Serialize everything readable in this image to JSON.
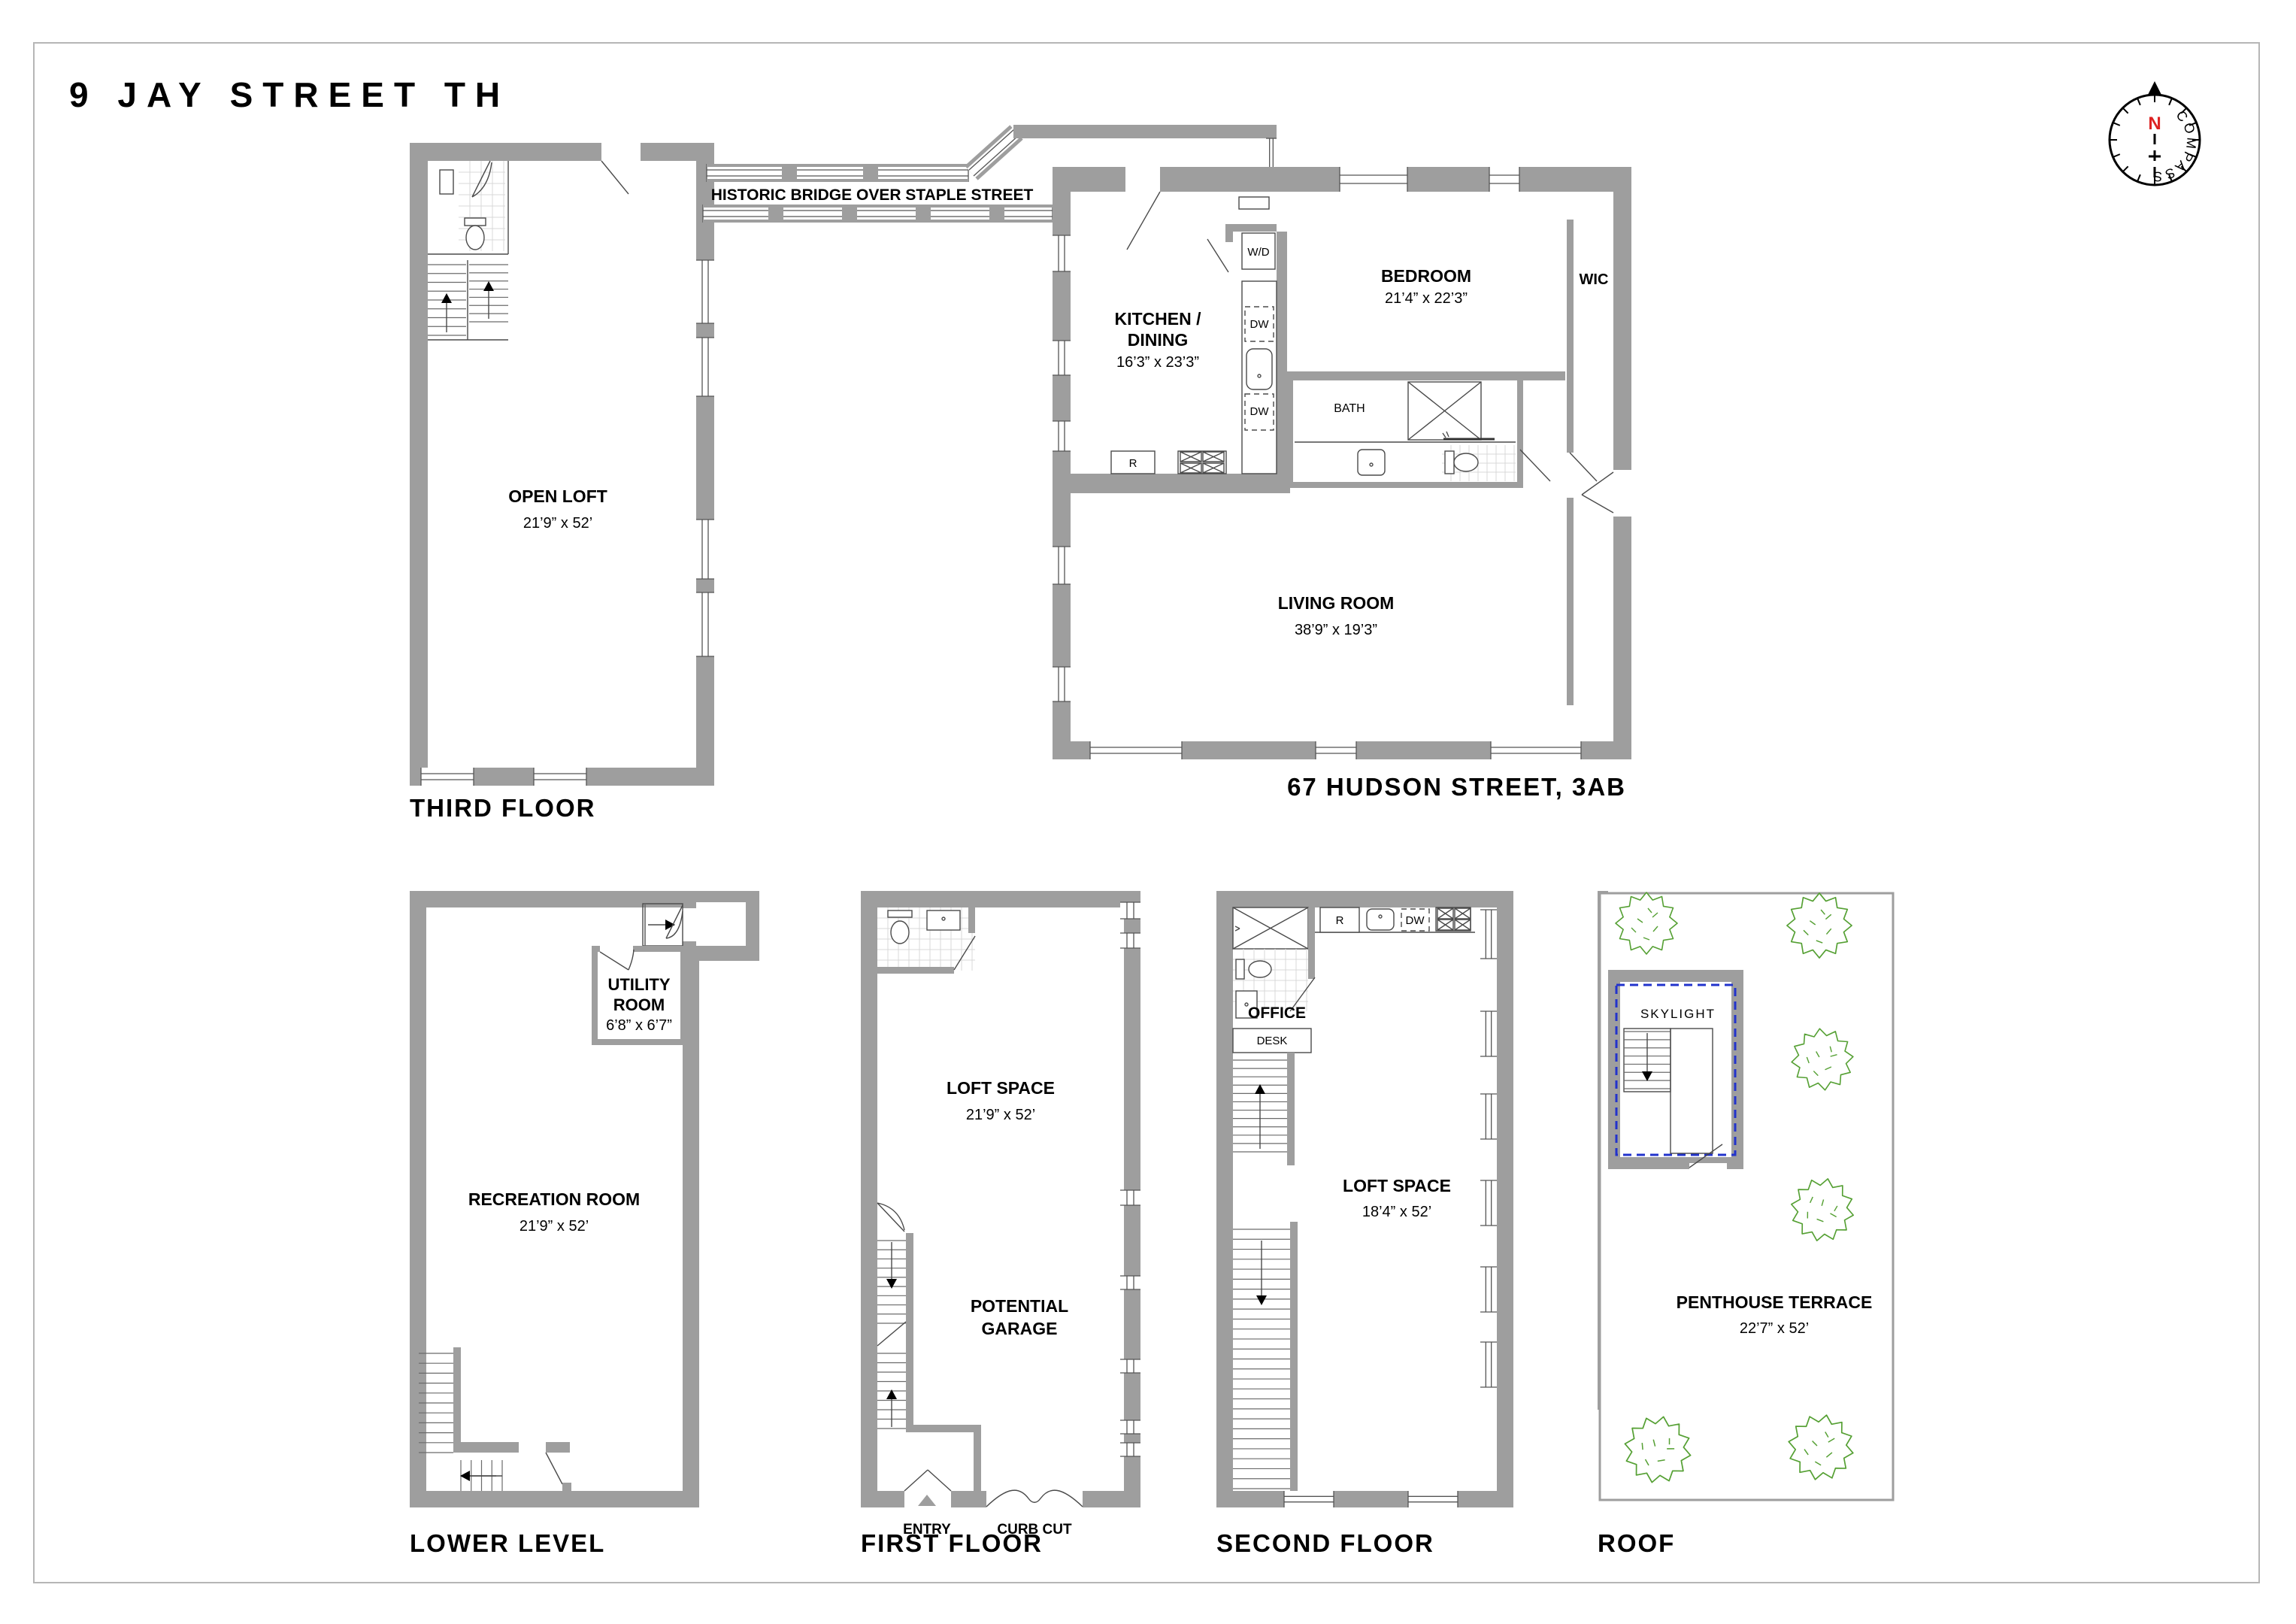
{
  "colors": {
    "wall": "#9e9e9e",
    "line": "#4a4a4a",
    "tree_green": "#55a033",
    "skylight_blue": "#2233cc",
    "north_red": "#dd2222",
    "page_border": "#b6b6b6"
  },
  "title": "9 JAY STREET TH",
  "compass": {
    "north": "N",
    "label": "COMPASS"
  },
  "bridge": {
    "label": "HISTORIC BRIDGE OVER STAPLE STREET"
  },
  "third_floor": {
    "floor_label": "THIRD FLOOR",
    "open_loft_name": "OPEN LOFT",
    "open_loft_dims": "21’9” x 52’"
  },
  "hudson": {
    "floor_label": "67 HUDSON STREET, 3AB",
    "kitchen_line1": "KITCHEN /",
    "kitchen_line2": "DINING",
    "kitchen_dims": "16’3” x 23’3”",
    "bedroom_name": "BEDROOM",
    "bedroom_dims": "21’4” x 22’3”",
    "living_name": "LIVING ROOM",
    "living_dims": "38’9” x 19’3”",
    "wic": "WIC",
    "bath": "BATH",
    "wd": "W/D",
    "dw_upper": "DW",
    "dw_lower": "DW",
    "fridge": "R"
  },
  "lower_level": {
    "floor_label": "LOWER LEVEL",
    "recreation_name": "RECREATION ROOM",
    "recreation_dims": "21’9” x 52’",
    "utility_line1": "UTILITY",
    "utility_line2": "ROOM",
    "utility_dims": "6’8” x 6’7”"
  },
  "first_floor": {
    "floor_label": "FIRST FLOOR",
    "loft_name": "LOFT SPACE",
    "loft_dims": "21’9” x 52’",
    "garage_line1": "POTENTIAL",
    "garage_line2": "GARAGE",
    "entry": "ENTRY",
    "curb_cut": "CURB CUT"
  },
  "second_floor": {
    "floor_label": "SECOND FLOOR",
    "loft_name": "LOFT SPACE",
    "loft_dims": "18’4” x 52’",
    "office": "OFFICE",
    "desk": "DESK",
    "fridge": "R",
    "dw": "DW"
  },
  "roof": {
    "floor_label": "ROOF",
    "terrace_name": "PENTHOUSE TERRACE",
    "terrace_dims": "22’7” x 52’",
    "skylight": "SKYLIGHT"
  }
}
